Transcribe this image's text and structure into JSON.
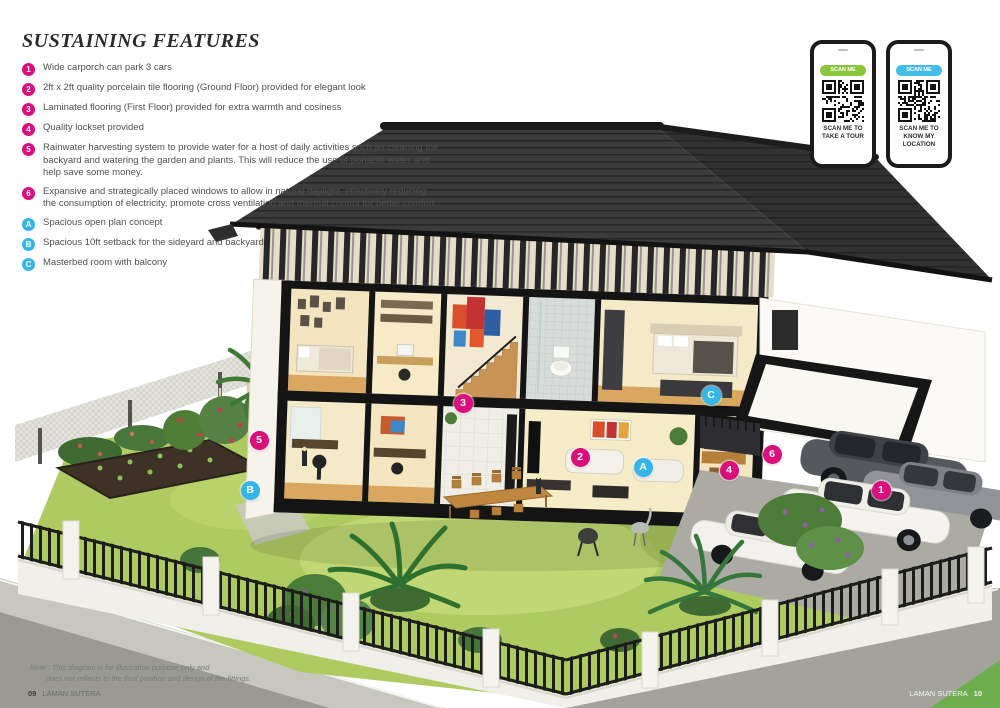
{
  "page": {
    "title": "SUSTAINING FEATURES",
    "note_line1": "Note : This diagram is for illustration purpose only and",
    "note_line2": "does not reflects to the final position and design of the fittings.",
    "footer_left_page": "09",
    "footer_left_text": "LAMAN SUTERA",
    "footer_right_text": "LAMAN SUTERA",
    "footer_right_page": "10"
  },
  "colors": {
    "feature_number_badge": "#db0f7b",
    "feature_letter_badge": "#35b6e9",
    "scan_badge_green": "#8cc63f",
    "scan_badge_blue": "#45bdea",
    "roof": "#3b3b3b",
    "lawn": "#aecb62"
  },
  "features": [
    {
      "id": "1",
      "type": "number",
      "text": "Wide carporch can park 3 cars"
    },
    {
      "id": "2",
      "type": "number",
      "text": "2ft x 2ft quality porcelain tile flooring (Ground Floor) provided for elegant look"
    },
    {
      "id": "3",
      "type": "number",
      "text": "Laminated flooring (First Floor) provided for extra warmth and cosiness"
    },
    {
      "id": "4",
      "type": "number",
      "text": "Quality lockset provided"
    },
    {
      "id": "5",
      "type": "number",
      "text": "Rainwater harvesting system to provide water for a host of daily activities such as cleaning the backyard and watering the garden and plants. This will reduce the use of portable water and help save some money."
    },
    {
      "id": "6",
      "type": "number",
      "text": "Expansive and strategically placed windows to allow in natural daylight, effectively reducing the consumption of electricity, promote cross ventilation and thermal control for better comfort"
    },
    {
      "id": "A",
      "type": "letter",
      "text": "Spacious open plan concept"
    },
    {
      "id": "B",
      "type": "letter",
      "text": "Spacious 10ft setback for the sideyard and backyard"
    },
    {
      "id": "C",
      "type": "letter",
      "text": "Masterbed room with balcony"
    }
  ],
  "phones": [
    {
      "badge": "SCAN ME",
      "badge_color": "#8cc63f",
      "caption_lines": [
        "SCAN ME TO",
        "TAKE A TOUR"
      ]
    },
    {
      "badge": "SCAN ME",
      "badge_color": "#45bdea",
      "caption_lines": [
        "SCAN ME TO",
        "KNOW MY",
        "LOCATION"
      ]
    }
  ],
  "markers": [
    {
      "id": "1",
      "type": "number",
      "x": 881,
      "y": 490
    },
    {
      "id": "2",
      "type": "number",
      "x": 580,
      "y": 457
    },
    {
      "id": "3",
      "type": "number",
      "x": 463,
      "y": 403
    },
    {
      "id": "4",
      "type": "number",
      "x": 729,
      "y": 470
    },
    {
      "id": "5",
      "type": "number",
      "x": 259,
      "y": 440
    },
    {
      "id": "6",
      "type": "number",
      "x": 772,
      "y": 454
    },
    {
      "id": "A",
      "type": "letter",
      "x": 643,
      "y": 467
    },
    {
      "id": "B",
      "type": "letter",
      "x": 250,
      "y": 490
    },
    {
      "id": "C",
      "type": "letter",
      "x": 711,
      "y": 395
    }
  ]
}
